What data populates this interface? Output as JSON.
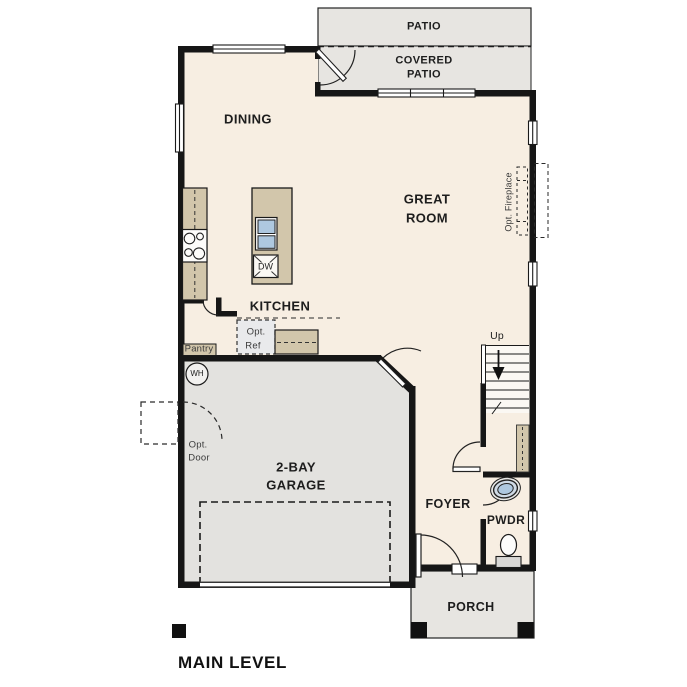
{
  "plan": {
    "title": "MAIN LEVEL",
    "rooms": {
      "patio": "PATIO",
      "covered_patio_1": "COVERED",
      "covered_patio_2": "PATIO",
      "dining": "DINING",
      "great_room_1": "GREAT",
      "great_room_2": "ROOM",
      "kitchen": "KITCHEN",
      "pantry": "Pantry",
      "garage_1": "2-BAY",
      "garage_2": "GARAGE",
      "foyer": "FOYER",
      "powder": "PWDR",
      "porch": "PORCH"
    },
    "labels": {
      "opt_fireplace": "Opt. Fireplace",
      "opt_ref_1": "Opt.",
      "opt_ref_2": "Ref",
      "opt_door_1": "Opt.",
      "opt_door_2": "Door",
      "water_heater": "WH",
      "dishwasher": "DW",
      "stairs_up": "Up"
    },
    "colors": {
      "wall": "#161616",
      "floor": "#f7eee2",
      "outdoor": "#e7e5e1",
      "garage_floor": "#e3e2df",
      "cabinet": "#d2c6ab",
      "sink_blue": "#aec8e0",
      "optional_fill": "#e9eaec"
    }
  }
}
